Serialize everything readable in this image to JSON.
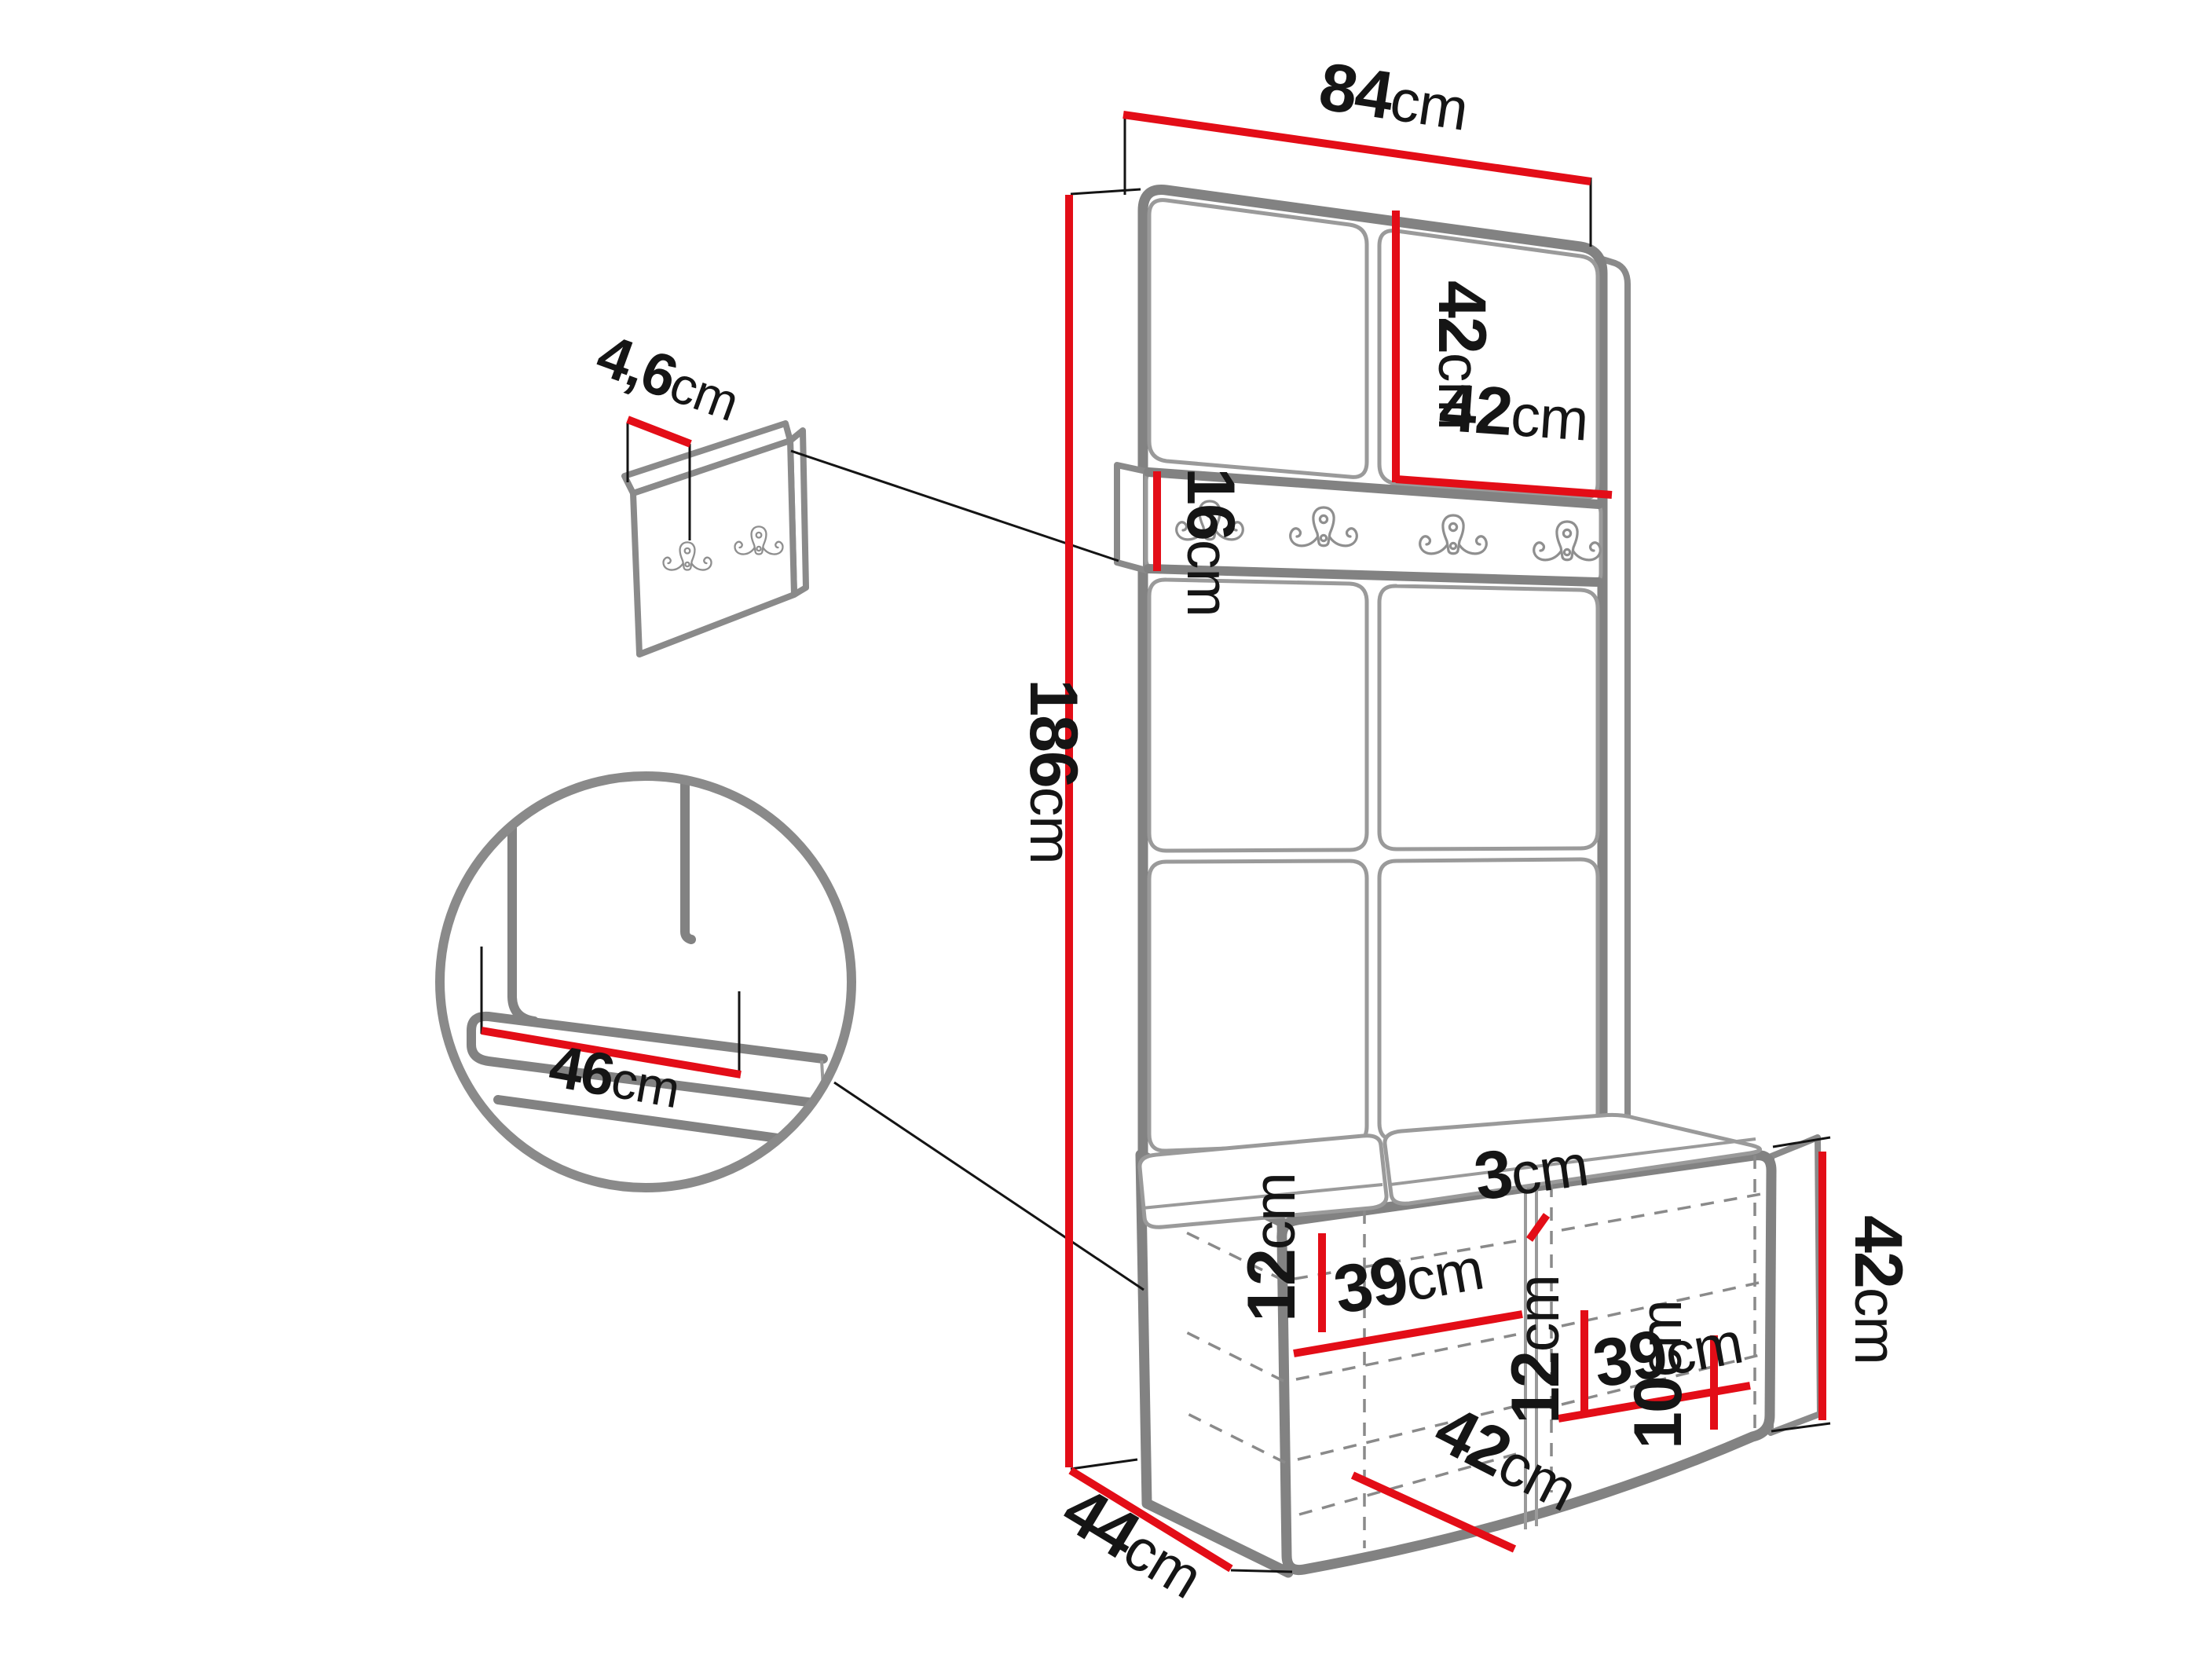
{
  "diagram": {
    "type": "furniture-dimension-diagram",
    "subject": "hallway wardrobe panel with hook rail and shoe bench",
    "background": "#ffffff",
    "colors": {
      "dimension_red": "#e30d17",
      "outline_gray": "#828282",
      "line_gray": "#9a9a9a",
      "text_black": "#151515"
    }
  },
  "dimensions": {
    "unit_width": {
      "value": "84",
      "unit": "cm"
    },
    "unit_height": {
      "value": "186",
      "unit": "cm"
    },
    "upper_panel_height": {
      "value": "42",
      "unit": "cm"
    },
    "upper_panel_width": {
      "value": "42",
      "unit": "cm"
    },
    "hook_rail_height": {
      "value": "16",
      "unit": "cm"
    },
    "wall_panel_thickness": {
      "value": "4,6",
      "unit": "cm"
    },
    "seat_depth_detail": {
      "value": "46",
      "unit": "cm"
    },
    "bench_left_top_offset": {
      "value": "12",
      "unit": "cm"
    },
    "bench_left_shelf_width": {
      "value": "39",
      "unit": "cm"
    },
    "bench_divider_width": {
      "value": "3",
      "unit": "cm"
    },
    "bench_right_top_offset": {
      "value": "12",
      "unit": "cm"
    },
    "bench_right_shelf_width": {
      "value": "39",
      "unit": "cm"
    },
    "bench_inner_width": {
      "value": "42",
      "unit": "cm"
    },
    "bench_bottom_offset": {
      "value": "10",
      "unit": "cm"
    },
    "bench_height": {
      "value": "42",
      "unit": "cm"
    },
    "bench_depth": {
      "value": "44",
      "unit": "cm"
    }
  },
  "components": {
    "main_unit": {
      "upper_panels": 2,
      "grid_panels": 4,
      "rail_hooks": 4
    },
    "wall_hook_panel": {
      "hooks": 2
    },
    "bench": {
      "compartments": 2,
      "cushions": 2
    },
    "detail_circle": {
      "shows": "seat cushion corner"
    }
  }
}
